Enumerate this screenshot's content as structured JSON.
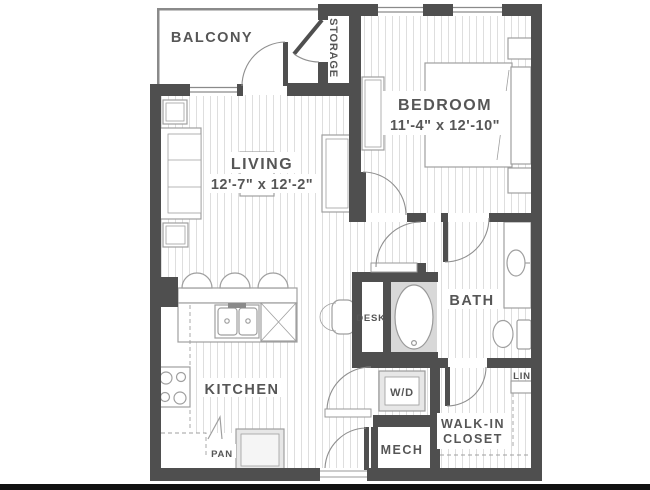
{
  "floorplan": {
    "balcony": {
      "label": "BALCONY"
    },
    "storage": {
      "label": "STORAGE"
    },
    "bedroom": {
      "label": "BEDROOM",
      "dims": "11'-4\" x 12'-10\""
    },
    "living": {
      "label": "LIVING",
      "dims": "12'-7\" x 12'-2\""
    },
    "kitchen": {
      "label": "KITCHEN"
    },
    "pantry": {
      "label": "PAN"
    },
    "desk": {
      "label": "DESK"
    },
    "bath": {
      "label": "BATH"
    },
    "laundry": {
      "label": "W/D"
    },
    "mech": {
      "label": "MECH"
    },
    "walk_in_closet": {
      "label_line1": "WALK-IN",
      "label_line2": "CLOSET"
    },
    "linen": {
      "label": "LIN"
    }
  },
  "colors": {
    "wall": "#4f4f4f",
    "thin_wall": "#8a8a8a",
    "floor_stripe": "#dedede",
    "furniture_line": "#9f9f9f",
    "text": "#565656",
    "tub_fill": "#d8d8d8",
    "appliance_fill": "#e7e7e7",
    "bottom_bar": "#111111"
  }
}
